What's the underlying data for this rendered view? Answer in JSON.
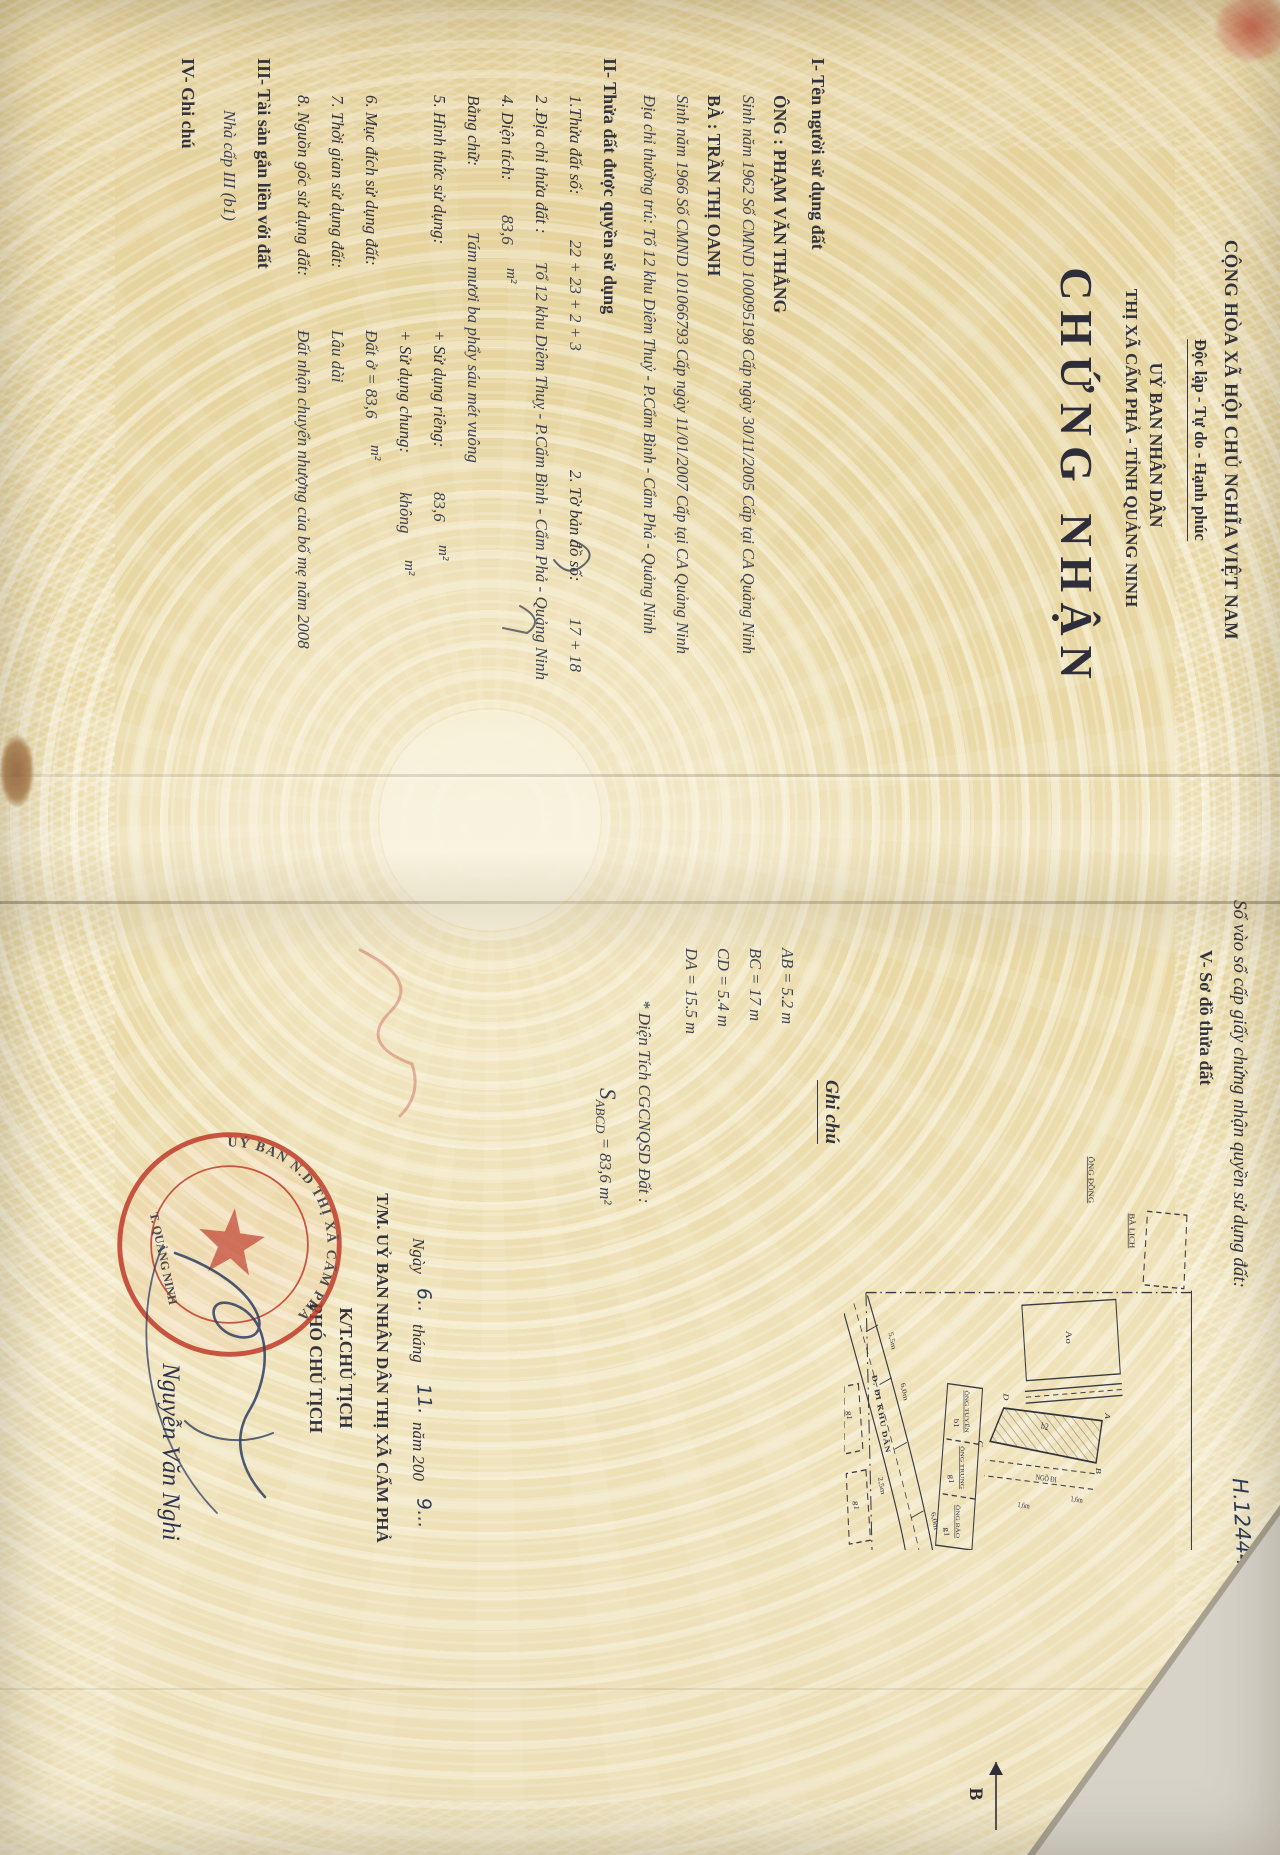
{
  "header": {
    "republic": "CỘNG HÒA XÃ HỘI CHỦ NGHĨA VIỆT NAM",
    "motto": "Độc lập - Tự do - Hạnh phúc",
    "issuer_line1": "UỶ BAN NHÂN DÂN",
    "issuer_line2": "THỊ XÃ CẨM PHẢ - TỈNH QUẢNG NINH",
    "certificate_title": "CHỨNG NHẬN"
  },
  "owner_section": {
    "heading": "I- Tên người sử dụng đất",
    "husband_name": "ÔNG : PHẠM VĂN THẮNG",
    "husband_info": "Sinh năm 1962 Số CMND  100095198   Cấp ngày  30/11/2005 Cấp tại CA  Quảng Ninh",
    "wife_name": "BÀ : TRẦN THỊ OANH",
    "wife_info": "Sinh năm 1966 Số CMND 101066793   Cấp ngày 11/01/2007  Cấp tại CA  Quảng Ninh",
    "address": "Địa chỉ thường trú: Tổ 12 khu Diêm Thuỷ - P.Cẩm Bình - Cẩm Phả - Quảng Ninh"
  },
  "parcel_section": {
    "heading": "II- Thửa đất được quyền sử dụng",
    "parcel_no_label": "1.Thửa đất số:",
    "parcel_no_value": "22 + 23 + 2 + 3",
    "sheet_label": "2. Tờ bản đồ số:",
    "sheet_value": "17 + 18",
    "address_label": "2 .Địa chỉ thửa đất :",
    "address_value": "Tổ 12 khu Diêm Thuỵ - P.Cẩm Bình - Cẩm Phả - Quảng Ninh",
    "area_label": "4. Diện tích:",
    "area_value": "83,6",
    "area_unit": "m²",
    "in_words_label": "Bằng chữ:",
    "in_words_value": "Tám mươi ba phẩy sáu mét vuông",
    "use_form_label": "5. Hình thức sử dụng:",
    "private_label": "+ Sử dụng riêng:",
    "private_value": "83,6",
    "private_unit": "m²",
    "common_label": "+ Sử dụng chung:",
    "common_value": "không",
    "common_unit": "m²",
    "purpose_label": "6. Mục đích sử dụng đất:",
    "purpose_value": "Đất ở =  83,6",
    "purpose_unit": "m²",
    "duration_label": "7. Thời gian sử dụng đất:",
    "duration_value": "Lâu dài",
    "origin_label": "8. Nguồn gốc sử dụng đất:",
    "origin_value": "Đất nhận chuyển nhượng của bố mẹ năm 2008"
  },
  "assets_section": {
    "heading": "III- Tài sản gắn liền với đất",
    "value": "Nhà cấp III (b1)"
  },
  "remarks_section": {
    "heading": "IV- Ghi chú"
  },
  "plan_section": {
    "registry_label": "Số vào sổ cấp giấy chứng nhận quyền sử dụng đất:",
    "registry_value": "H.12444",
    "heading": "V- Sơ đồ thửa đất",
    "legend_heading": "Ghi chú",
    "dim_ab": "AB = 5.2 m",
    "dim_bc": "BC = 17 m",
    "dim_cd": "CD = 5.4 m",
    "dim_da": "DA = 15.5 m",
    "area_note_label": "* Diện Tích CGCNQSD Đất :",
    "area_note_s": "S",
    "area_note_sub": "ABCD",
    "area_note_value": "= 83,6 m²",
    "compass_label": "B"
  },
  "map": {
    "plot_ao": "Ao",
    "plot_b2": "b2",
    "plot_b1": "b1",
    "plot_g1a": "g1",
    "plot_g1b": "g1",
    "plot_g1c": "g1",
    "plot_g1d": "g1",
    "owner_ba_lich": "BÀ LỊCH",
    "owner_ong_dong": "ÔNG ĐỒNG",
    "owner_ong_tuyen": "ÔNG TUYẾN",
    "owner_ong_trung": "ÔNG TRUNG",
    "owner_ong_bao": "ÔNG BẢO",
    "road": "Đ. ĐI KHU DÂN",
    "alley": "NGÕ ĐI",
    "corner_a": "A",
    "corner_b": "B",
    "corner_c": "C",
    "corner_d": "D",
    "dim1": "5,5m",
    "dim2": "6,0m",
    "dim3": "6,0m",
    "dim4": "2,5m",
    "dim5": "1,6m",
    "dim6": "1,6m"
  },
  "signing": {
    "date_ngay": "Ngày",
    "date_day": "6..",
    "date_thang": "tháng",
    "date_month": "11.",
    "date_nam": "năm 200",
    "date_year": "9...",
    "behalf": "T/M. UỶ BAN NHÂN DÂN THỊ XÃ CẨM PHẢ",
    "kt": "K/T.CHỦ TỊCH",
    "position": "PHÓ CHỦ TỊCH",
    "signer": "Nguyễn Văn Nghi"
  },
  "seal": {
    "text_top": "UỶ BAN N.D THỊ XÃ CẨM PHẢ",
    "text_bottom": "T. QUẢNG NINH"
  }
}
